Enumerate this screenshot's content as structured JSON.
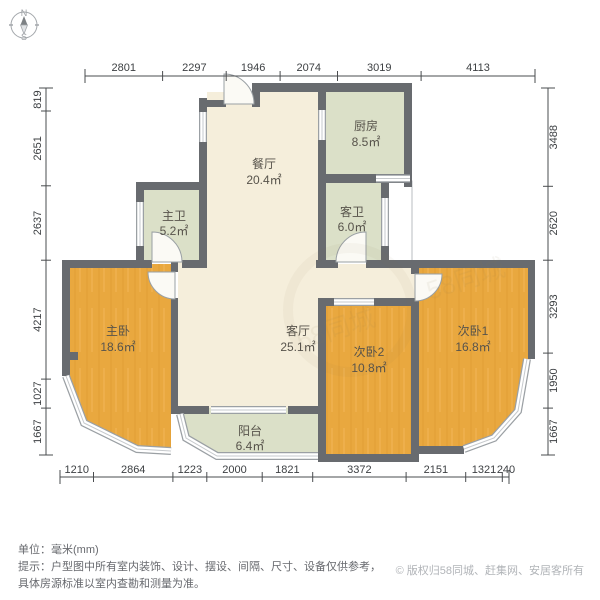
{
  "compass": {
    "north_label": "N",
    "south_label": "S"
  },
  "rooms": [
    {
      "name": "餐厅",
      "area": "20.4㎡"
    },
    {
      "name": "厨房",
      "area": "8.5㎡"
    },
    {
      "name": "主卫",
      "area": "5.2㎡"
    },
    {
      "name": "客卫",
      "area": "6.0㎡"
    },
    {
      "name": "主卧",
      "area": "18.6㎡"
    },
    {
      "name": "客厅",
      "area": "25.1㎡"
    },
    {
      "name": "次卧2",
      "area": "10.8㎡"
    },
    {
      "name": "次卧1",
      "area": "16.8㎡"
    },
    {
      "name": "阳台",
      "area": "6.4㎡"
    }
  ],
  "dims": {
    "top": [
      "2801",
      "2297",
      "1946",
      "2074",
      "3019",
      "4113"
    ],
    "left": [
      "819",
      "2651",
      "2637",
      "4217",
      "1027",
      "1667"
    ],
    "right": [
      "3488",
      "2620",
      "3293",
      "1950",
      "1667"
    ],
    "bottom": [
      "1210",
      "2864",
      "1223",
      "2000",
      "1821",
      "3372",
      "2151",
      "1321",
      "240"
    ]
  },
  "watermark": {
    "text": "58同城"
  },
  "footer": {
    "unit_label": "单位：毫米(mm)",
    "note_line1": "提示：户型图中所有室内装饰、设计、摆设、间隔、尺寸、设备仅供参考，",
    "note_line2": "具体房源标准以室内查勘和测量为准。",
    "copyright": "© 版权归58同城、赶集网、安居客所有"
  },
  "colors": {
    "wall": "#686b6f",
    "floor_living": "#f5eedb",
    "floor_wet": "#dbe0c8",
    "floor_wood": "#e9a83f",
    "window_frame": "#9ba0a4",
    "dim_text": "#3d4043",
    "label_text": "#57534b",
    "copyright_text": "#b1b4b8"
  }
}
